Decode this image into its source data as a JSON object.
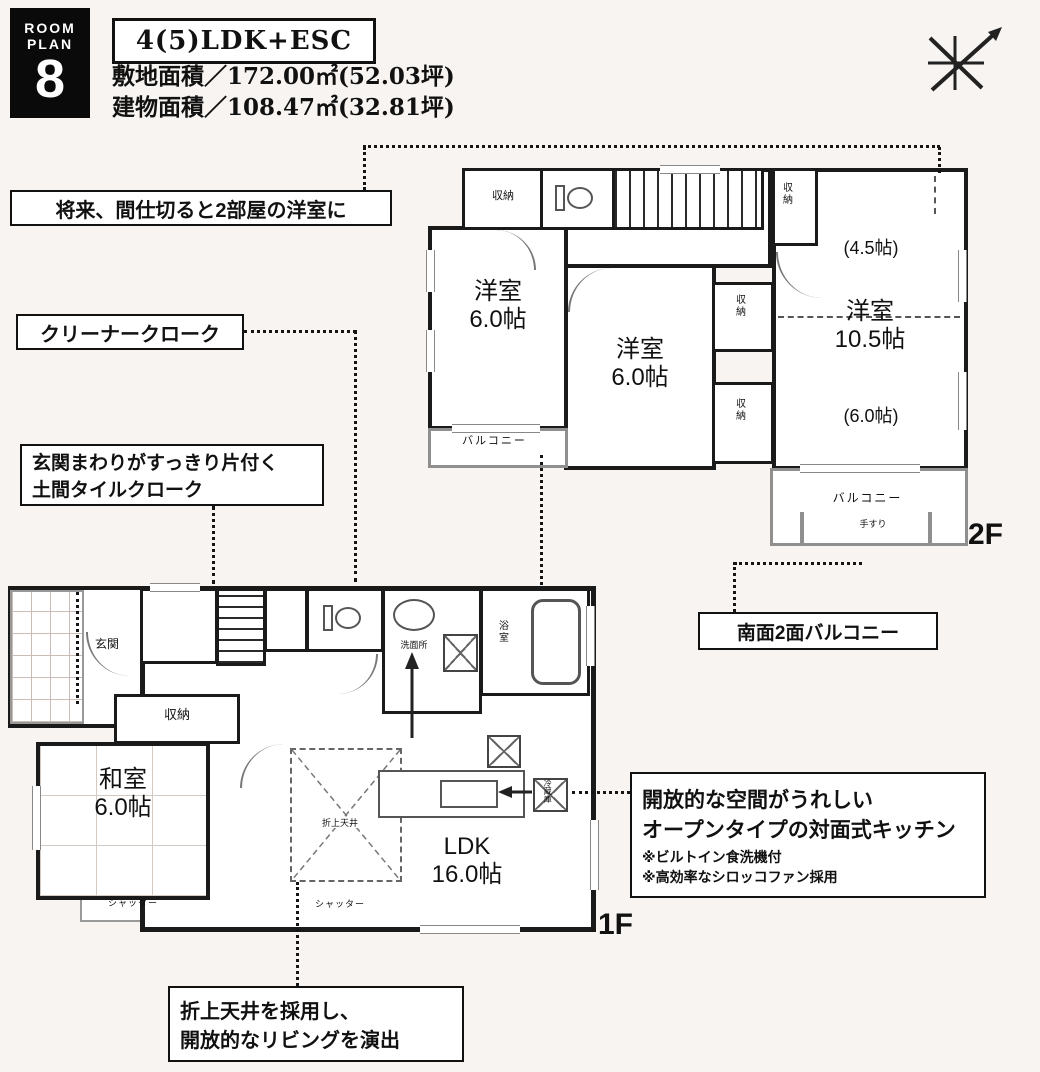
{
  "colors": {
    "ink": "#111111",
    "wall": "#1a1a1a",
    "gray_wall": "#8f8f8f",
    "bg": "#f7f4f1"
  },
  "header": {
    "badge_line1": "ROOM",
    "badge_line2": "PLAN",
    "badge_number": "8",
    "plan_type": "4(5)LDK+ESC",
    "site_area": "敷地面積／172.00㎡(52.03坪)",
    "building_area": "建物面積／108.47㎡(32.81坪)"
  },
  "callouts": {
    "future_partition": "将来、間仕切ると2部屋の洋室に",
    "cleaner_cloak": "クリーナークローク",
    "entrance_line1": "玄関まわりがすっきり片付く",
    "entrance_line2": "土間タイルクローク",
    "south_balcony": "南面2面バルコニー",
    "kitchen_line1": "開放的な空間がうれしい",
    "kitchen_line2": "オープンタイプの対面式キッチン",
    "kitchen_note1": "※ビルトイン食洗機付",
    "kitchen_note2": "※高効率なシロッコファン採用",
    "ceiling_line1": "折上天井を採用し、",
    "ceiling_line2": "開放的なリビングを演出"
  },
  "floor2": {
    "floor_label": "2F",
    "west_room_name": "洋室",
    "west_room_size": "6.0帖",
    "middle_room_name": "洋室",
    "middle_room_size": "6.0帖",
    "east_room_name": "洋室",
    "east_room_size": "10.5帖",
    "east_room_upper": "(4.5帖)",
    "east_room_lower": "(6.0帖)",
    "closet": "収納",
    "balcony": "バルコニー",
    "handrail": "手すり"
  },
  "floor1": {
    "floor_label": "1F",
    "entrance": "玄関",
    "closet": "収納",
    "washroom": "洗面所",
    "bath": "浴室",
    "japanese_room_name": "和室",
    "japanese_room_size": "6.0帖",
    "ldk_name": "LDK",
    "ldk_size": "16.0帖",
    "raised_ceiling": "折上天井",
    "fridge": "冷蔵庫",
    "shutter": "シャッター"
  }
}
